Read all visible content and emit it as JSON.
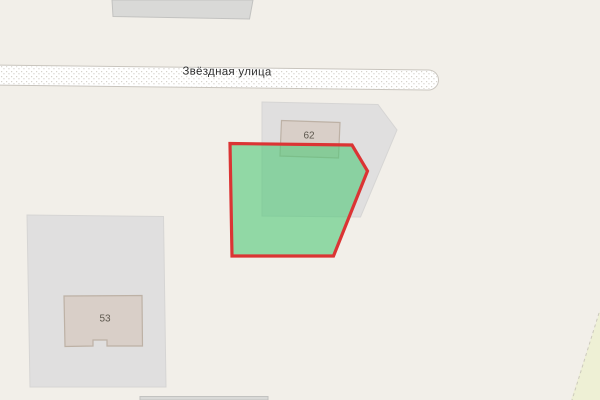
{
  "map": {
    "street_label": "Звёздная улица",
    "buildings": [
      {
        "number": "62"
      },
      {
        "number": "53"
      }
    ],
    "highlight": {
      "fill": "rgba(80,200,120,0.6)",
      "stroke": "#db3434",
      "stroke_width": "3.2"
    },
    "colors": {
      "background": "#f2efe9",
      "landuse": "#e0dfdf",
      "landuse_stroke": "#d6d5d4",
      "building_fill": "#d9cfc8",
      "building_stroke": "#bdb1a5",
      "gray_building_fill": "#d9d9d7",
      "gray_building_stroke": "#c2c2c0",
      "road_fill": "#ffffff",
      "road_casing": "#c9c5be",
      "farmland": "#eef0d5",
      "farmland_stroke": "#ccc9bd",
      "street_text": "#2d2d2d",
      "housenumber_text": "#5c564d"
    }
  }
}
